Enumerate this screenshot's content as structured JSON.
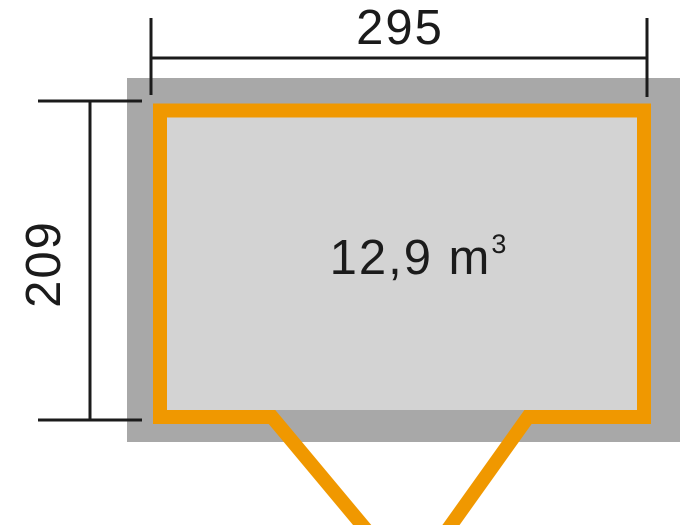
{
  "diagram": {
    "dimensions": {
      "width_label": "295",
      "height_label": "209"
    },
    "volume": {
      "value": "12,9 m",
      "exponent": "3"
    }
  },
  "colors": {
    "wall": "#f09800",
    "footprint": "#a8a8a8",
    "interior": "#d3d3d3",
    "line": "#1b1b1b"
  }
}
